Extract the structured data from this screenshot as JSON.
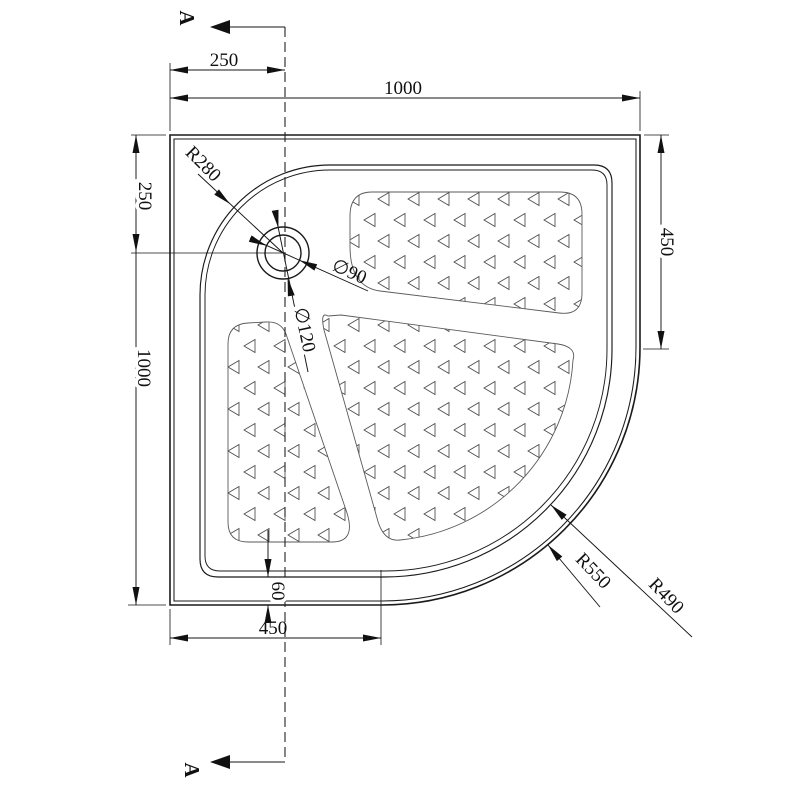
{
  "drawing": {
    "type": "quadrant-shower-tray-plan",
    "section": {
      "label_top": "A",
      "label_bottom": "A"
    },
    "dimensions": {
      "top_width": "1000",
      "top_drain_offset": "250",
      "left_drain_offset": "250",
      "left_height": "1000",
      "right_straight_edge": "450",
      "bottom_straight_edge": "450",
      "ledge_depth": "60",
      "inner_corner_radius": "R280",
      "drain_inner_diameter": "∅90",
      "drain_outer_diameter": "∅120",
      "outer_curve_radius": "R550",
      "inner_curve_radius": "R490"
    },
    "colors": {
      "background": "#ffffff",
      "line": "#1a1a1a",
      "dimension": "#141414",
      "pad_border": "#5a5a5a",
      "triangle": "#4a4a4a"
    }
  }
}
